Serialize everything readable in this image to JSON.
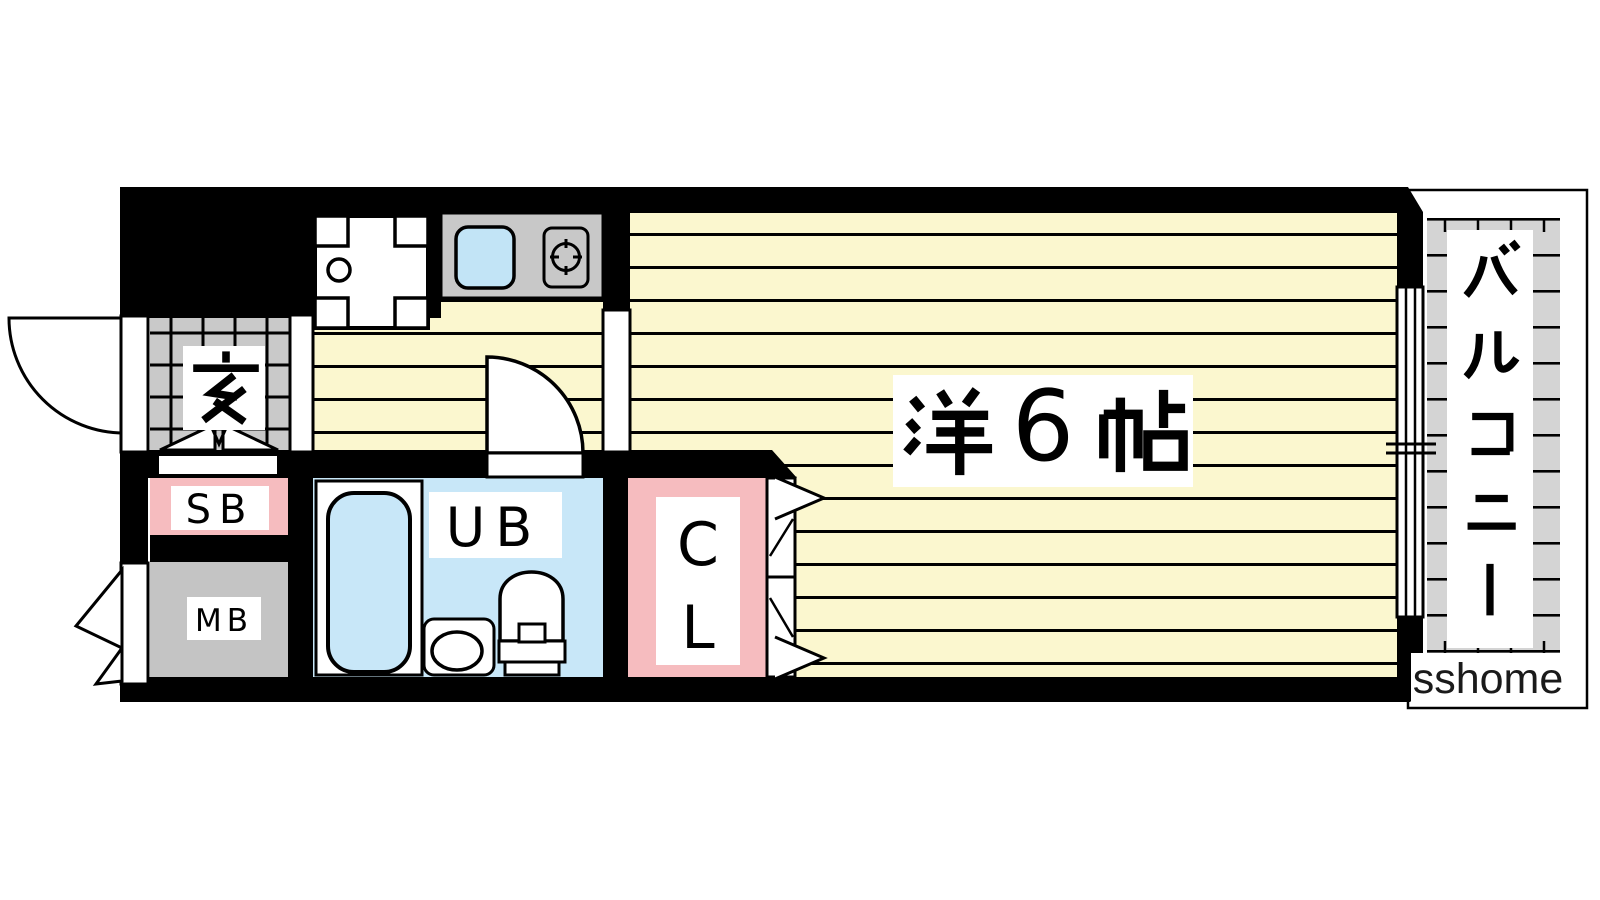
{
  "page": {
    "type": "apartment floor plan",
    "background": "#ffffff"
  },
  "rooms": {
    "entrance": {
      "label": "玄"
    },
    "shoe_box": {
      "label": "SB"
    },
    "meter_box": {
      "label": "MB"
    },
    "unit_bath": {
      "label": "UB"
    },
    "closet": {
      "letters": [
        "C",
        "L"
      ]
    },
    "main_room": {
      "label": "洋6帖",
      "kanji_prefix": "洋",
      "size_digit": "6",
      "kanji_suffix": "帖"
    },
    "balcony": {
      "label": "バルコニー",
      "chars": [
        "バ",
        "ル",
        "コ",
        "ニ",
        "ー"
      ]
    }
  },
  "watermark": {
    "text": "sshome"
  },
  "colors": {
    "wall": "#000000",
    "floor_yellow": "#FBF7CF",
    "entrance_tile_gray": "#C9C9C9",
    "unit_bath_blue": "#C8E7F8",
    "sink_blue": "#C2E4F6",
    "closet_pink": "#F6BCBF",
    "shoe_box_pink": "#F6BCBF",
    "meter_box_gray": "#C4C4C4",
    "kitchen_unit_gray": "#C8C8C8",
    "balcony_floor_gray": "#D4D4D4",
    "watermark_text": "#1A1A1A"
  }
}
